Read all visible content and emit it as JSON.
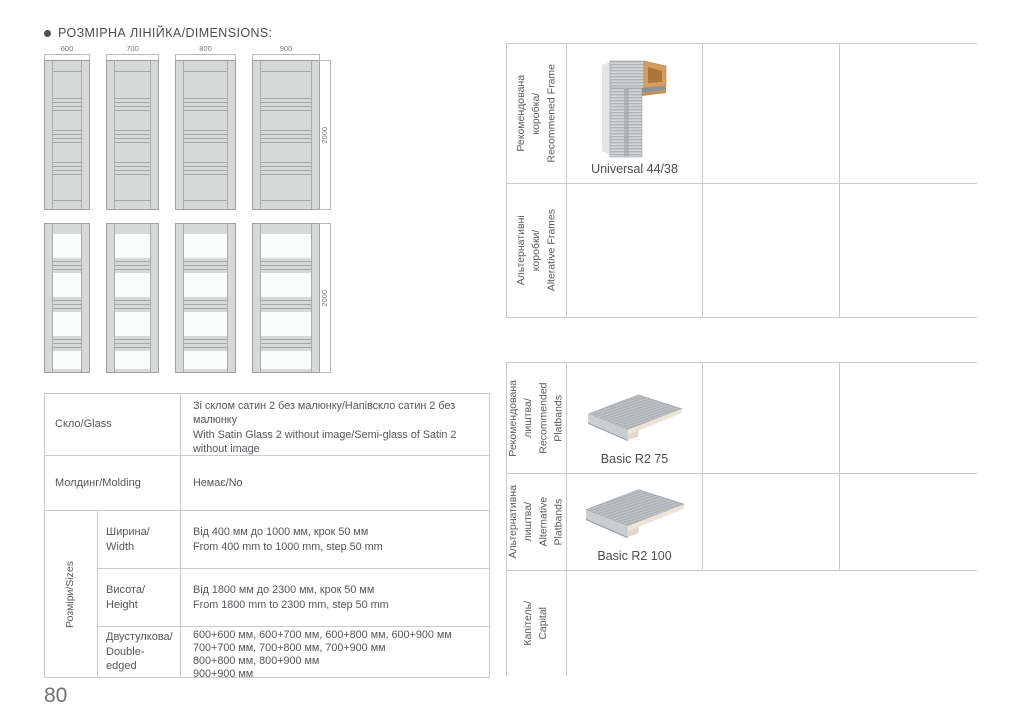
{
  "page": {
    "title": "РОЗМІРНА ЛІНІЙКА/DIMENSIONS:",
    "number": "80"
  },
  "dimensions_diagram": {
    "width_labels": [
      "600",
      "700",
      "800",
      "900"
    ],
    "height_label": "2000"
  },
  "specs_table": {
    "rows": [
      {
        "label": "Скло/Glass",
        "value": "Зі склом сатин 2 без малюнку/Напівскло сатин 2 без малюнку\nWith Satin Glass 2 without image/Semi-glass of Satin 2 without image"
      },
      {
        "label": "Молдинг/Molding",
        "value": "Немає/No"
      }
    ],
    "sizes_group_label": "Розміри/Sizes",
    "sizes_rows": [
      {
        "label": "Ширина/\nWidth",
        "value": "Від 400 мм до 1000 мм, крок 50 мм\nFrom 400 mm to 1000 mm, step 50 mm"
      },
      {
        "label": "Висота/\nHeight",
        "value": "Від 1800 мм до 2300 мм, крок 50 мм\nFrom 1800 mm to 2300 mm, step 50 mm"
      },
      {
        "label": "Двустулкова/\nDouble-edged",
        "value": "600+600 мм, 600+700 мм, 600+800 мм, 600+900 мм\n700+700 мм, 700+800 мм, 700+900 мм\n800+800 мм, 800+900 мм\n900+900 мм"
      }
    ]
  },
  "frames_table": {
    "rows": [
      {
        "label": "Рекомендована\nкоробка/\nRecommened Frame",
        "product": "Universal 44/38"
      },
      {
        "label": "Альтернативні\nкоробки/\nAlterative Frames",
        "product": ""
      }
    ]
  },
  "platbands_table": {
    "rows": [
      {
        "label": "Рекомендована\nлиштва/\nRecommended\nPlatbands",
        "product": "Basic R2 75"
      },
      {
        "label": "Альтернативна\nлиштва/\nAlternative\nPlatbands",
        "product": "Basic R2 100"
      },
      {
        "label": "Капітель/\nCapital",
        "product": ""
      }
    ]
  },
  "colors": {
    "text": "#55565a",
    "border": "#c9cacb",
    "door_fill": "#d7d9d8",
    "door_line": "#9da0a1",
    "wood": "#d39f60"
  }
}
